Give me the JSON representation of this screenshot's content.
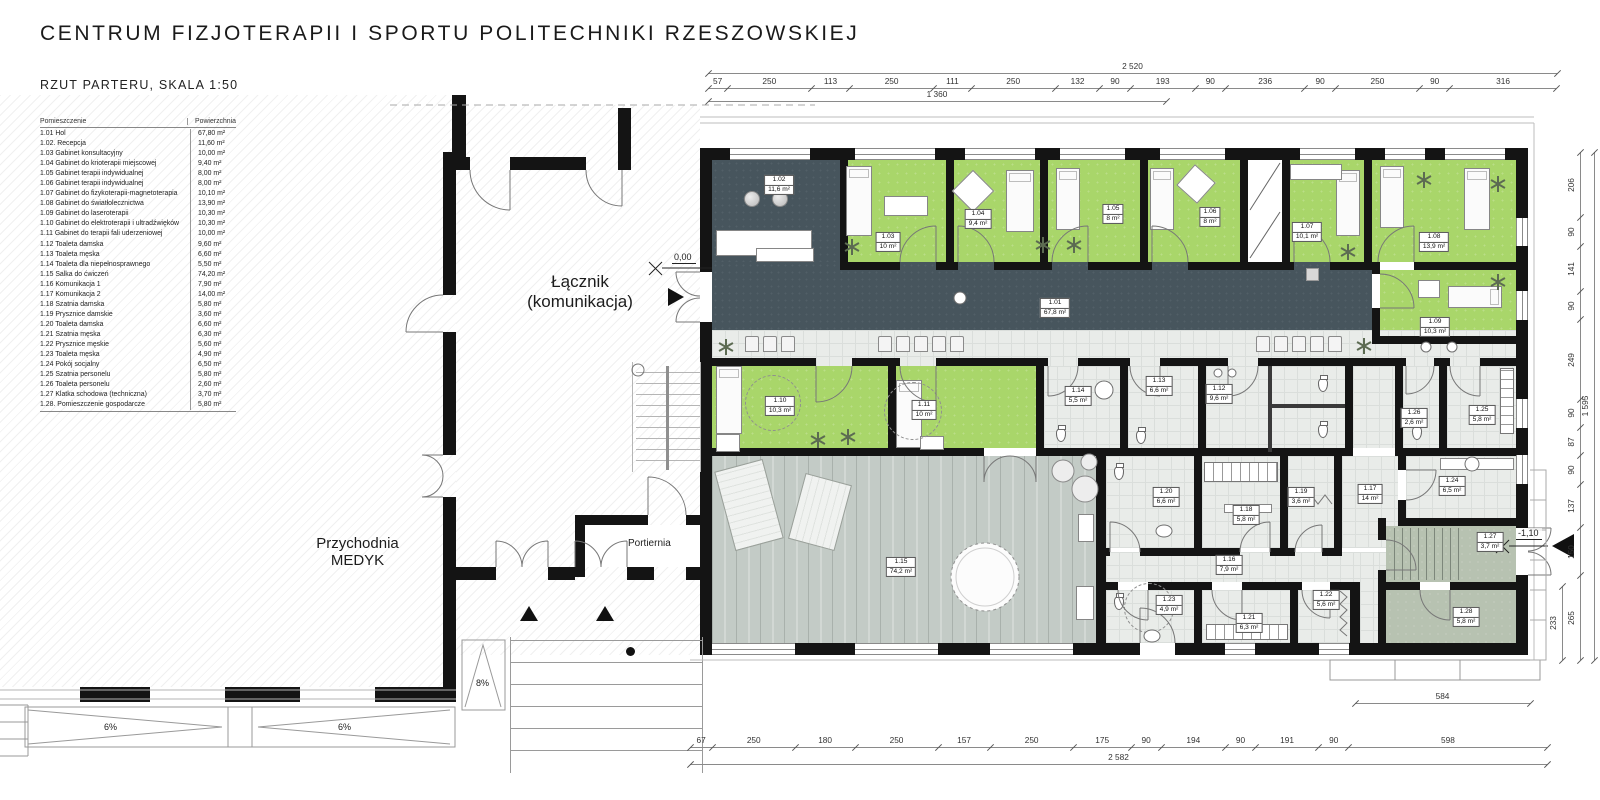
{
  "header": {
    "title": "CENTRUM FIZJOTERAPII I SPORTU POLITECHNIKI RZESZOWSKIEJ",
    "subtitle": "RZUT PARTERU, SKALA 1:50"
  },
  "legend": {
    "col_room": "Pomieszczenie",
    "col_area": "Powierzchnia",
    "rows": [
      [
        "1.01 Hol",
        "67,80 m²"
      ],
      [
        "1.02. Recepcja",
        "11,60 m²"
      ],
      [
        "1.03 Gabinet konsultacyjny",
        "10,00 m²"
      ],
      [
        "1.04 Gabinet do krioterapii miejscowej",
        "9,40 m²"
      ],
      [
        "1.05 Gabinet terapii indywidualnej",
        "8,00 m²"
      ],
      [
        "1.06 Gabinet terapii indywidualnej",
        "8,00 m²"
      ],
      [
        "1.07 Gabinet do fizykoterapii-magnetoterapia",
        "10,10 m²"
      ],
      [
        "1.08 Gabinet do światłolecznictwa",
        "13,90 m²"
      ],
      [
        "1.09 Gabinet do laseroterapii",
        "10,30 m²"
      ],
      [
        "1.10 Gabinet do elektroterapii i ultradźwięków",
        "10,30 m²"
      ],
      [
        "1.11 Gabinet do terapii fali uderzeniowej",
        "10,00 m²"
      ],
      [
        "1.12 Toaleta damska",
        "9,60 m²"
      ],
      [
        "1.13 Toaleta męska",
        "6,60 m²"
      ],
      [
        "1.14 Toaleta dla niepełnosprawnego",
        "5,50 m²"
      ],
      [
        "1.15 Salka do ćwiczeń",
        "74,20 m²"
      ],
      [
        "1.16 Komunikacja 1",
        "7,90 m²"
      ],
      [
        "1.17 Komunikacja 2",
        "14,00 m²"
      ],
      [
        "1.18 Szatnia damska",
        "5,80 m²"
      ],
      [
        "1.19 Prysznice damskie",
        "3,60 m²"
      ],
      [
        "1.20 Toaleta damska",
        "6,60 m²"
      ],
      [
        "1.21 Szatnia męska",
        "6,30 m²"
      ],
      [
        "1.22 Prysznice męskie",
        "5,60 m²"
      ],
      [
        "1.23 Toaleta męska",
        "4,90 m²"
      ],
      [
        "1.24 Pokój socjalny",
        "6,50 m²"
      ],
      [
        "1.25 Szatnia personelu",
        "5,80 m²"
      ],
      [
        "1.26 Toaleta personelu",
        "2,60 m²"
      ],
      [
        "1.27 Klatka schodowa (techniczna)",
        "3,70 m²"
      ],
      [
        "1.28. Pomieszczenie gospodarcze",
        "5,80 m²"
      ]
    ]
  },
  "plan": {
    "labels": [
      [
        "1.01",
        "67,8 m²",
        1055,
        308
      ],
      [
        "1.02",
        "11,6 m²",
        779,
        185
      ],
      [
        "1.03",
        "10 m²",
        888,
        242
      ],
      [
        "1.04",
        "9,4 m²",
        978,
        219
      ],
      [
        "1.05",
        "8 m²",
        1113,
        214
      ],
      [
        "1.06",
        "8 m²",
        1210,
        217
      ],
      [
        "1.07",
        "10,1 m²",
        1307,
        232
      ],
      [
        "1.08",
        "13,9 m²",
        1434,
        242
      ],
      [
        "1.09",
        "10,3 m²",
        1435,
        327
      ],
      [
        "1.10",
        "10,3 m²",
        780,
        406
      ],
      [
        "1.11",
        "10 m²",
        924,
        410
      ],
      [
        "1.12",
        "9,6 m²",
        1219,
        394
      ],
      [
        "1.13",
        "6,6 m²",
        1159,
        386
      ],
      [
        "1.14",
        "5,5 m²",
        1078,
        396
      ],
      [
        "1.15",
        "74,2 m²",
        901,
        567
      ],
      [
        "1.16",
        "7,9 m²",
        1229,
        565
      ],
      [
        "1.17",
        "14 m²",
        1370,
        494
      ],
      [
        "1.18",
        "5,8 m²",
        1246,
        515
      ],
      [
        "1.19",
        "3,6 m²",
        1301,
        497
      ],
      [
        "1.20",
        "6,6 m²",
        1166,
        497
      ],
      [
        "1.21",
        "6,3 m²",
        1249,
        623
      ],
      [
        "1.22",
        "5,6 m²",
        1326,
        600
      ],
      [
        "1.23",
        "4,9 m²",
        1169,
        605
      ],
      [
        "1.24",
        "6,5 m²",
        1452,
        486
      ],
      [
        "1.25",
        "5,8 m²",
        1482,
        415
      ],
      [
        "1.26",
        "2,6 m²",
        1414,
        418
      ],
      [
        "1.27",
        "3,7 m²",
        1490,
        542
      ],
      [
        "1.28",
        "5,8 m²",
        1466,
        617
      ]
    ],
    "annotations": {
      "lacznik_1": "Łącznik",
      "lacznik_2": "(komunikacja)",
      "przychodnia_1": "Przychodnia",
      "przychodnia_2": "MEDYK",
      "portiernia": "Portiernia",
      "level_zero": "0,00",
      "level_minus": "-1,10",
      "ramp_a": "6%",
      "ramp_b": "6%",
      "ramp_c": "8%"
    }
  },
  "dimensions": {
    "top_total": "2 520",
    "top_segments": [
      "57",
      "250",
      "113",
      "250",
      "111",
      "250",
      "132",
      "90",
      "193",
      "90",
      "236",
      "90",
      "250",
      "90",
      "316"
    ],
    "top_partial": "1 360",
    "bottom_segments": [
      "67",
      "250",
      "180",
      "250",
      "157",
      "250",
      "175",
      "90",
      "194",
      "90",
      "191",
      "90",
      "598"
    ],
    "bottom_total": "2 582",
    "right_segments": [
      "206",
      "90",
      "141",
      "90",
      "249",
      "90",
      "87",
      "90",
      "137",
      "150",
      "265"
    ],
    "right_total": "1 595",
    "right_inner": "233",
    "bottom_right": "584"
  },
  "colors": {
    "room_green": "#a9d66a",
    "hall_dark": "#47555d",
    "tile_light": "#e9ece9",
    "wood_gray": "#c3cbc6",
    "sage": "#b7c2b1",
    "wall": "#141414"
  }
}
